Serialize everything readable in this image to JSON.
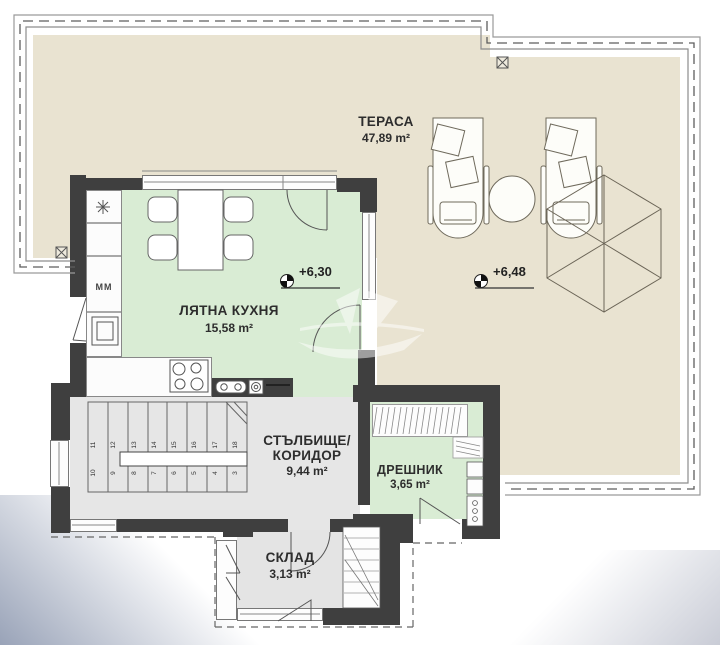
{
  "drawing": {
    "type": "architectural-floor-plan",
    "floor_note": "roof terrace level"
  },
  "rooms": {
    "terrace": {
      "name": "ТЕРАСА",
      "area": "47,89 m²"
    },
    "summer_kitchen": {
      "name": "ЛЯТНА КУХНЯ",
      "area": "15,58 m²"
    },
    "stair_corridor": {
      "name_line1": "СТЪЛБИЩЕ/",
      "name_line2": "КОРИДОР",
      "area": "9,44 m²"
    },
    "wardrobe": {
      "name": "ДРЕШНИК",
      "area": "3,65 m²"
    },
    "storage": {
      "name": "СКЛАД",
      "area": "3,13 m²"
    }
  },
  "annotations": {
    "elevation_markers": [
      {
        "label": "+6,30"
      },
      {
        "label": "+6,48"
      }
    ],
    "appliance_label": "ММ",
    "stair_numbers_upper": [
      "11",
      "12",
      "13",
      "14",
      "15",
      "16",
      "17",
      "18"
    ],
    "stair_numbers_lower": [
      "10",
      "9",
      "8",
      "7",
      "6",
      "5",
      "4",
      "3"
    ]
  },
  "colors": {
    "terrace_fill": "#e9e3d1",
    "room_green": "#d9ecd4",
    "room_gray": "#e6e6e6",
    "wall_dark": "#3f3f3f",
    "line": "#666666",
    "gradient_blue": "#99a3b8"
  }
}
